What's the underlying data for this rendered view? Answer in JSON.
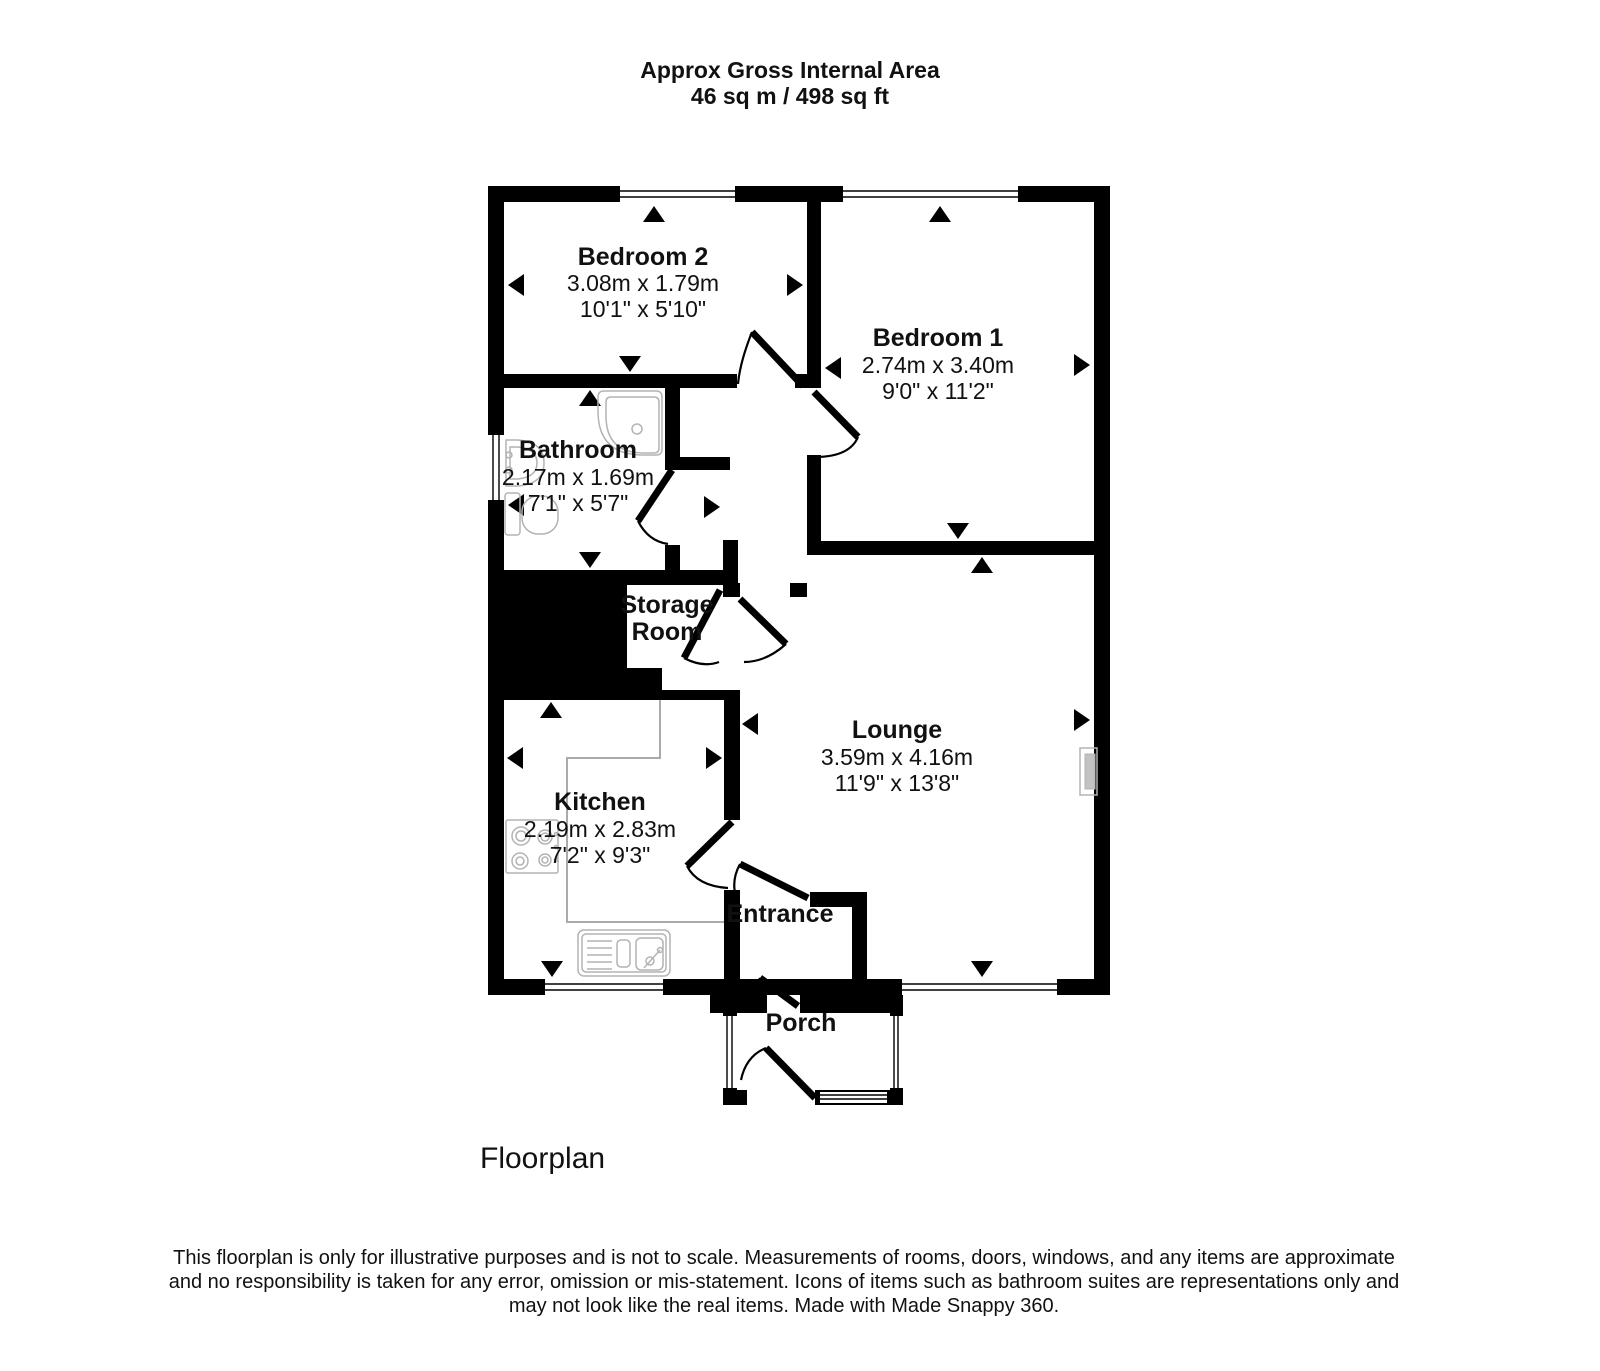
{
  "title": {
    "line1": "Approx Gross Internal Area",
    "line2": "46 sq m / 498 sq ft"
  },
  "rooms": {
    "bedroom2": {
      "name": "Bedroom 2",
      "metric": "3.08m x 1.79m",
      "imperial": "10'1\" x 5'10\""
    },
    "bedroom1": {
      "name": "Bedroom 1",
      "metric": "2.74m x 3.40m",
      "imperial": "9'0\" x 11'2\""
    },
    "bathroom": {
      "name": "Bathroom",
      "metric": "2.17m x 1.69m",
      "imperial": "7'1\" x 5'7\""
    },
    "storage": {
      "name_line1": "Storage",
      "name_line2": "Room"
    },
    "lounge": {
      "name": "Lounge",
      "metric": "3.59m x 4.16m",
      "imperial": "11'9\" x 13'8\""
    },
    "kitchen": {
      "name": "Kitchen",
      "metric": "2.19m x 2.83m",
      "imperial": "7'2\" x 9'3\""
    },
    "entrance": {
      "name": "Entrance"
    },
    "porch": {
      "name": "Porch"
    }
  },
  "footer": {
    "caption": "Floorplan",
    "disclaimer_line1": "This floorplan is only for illustrative purposes and is not to scale. Measurements of rooms, doors, windows, and any items are approximate",
    "disclaimer_line2": "and no responsibility is taken for any error, omission or mis-statement. Icons of items such as bathroom suites are representations only and",
    "disclaimer_line3": "may not look like the real items. Made with Made Snappy 360."
  },
  "colors": {
    "wall": "#000000",
    "background": "#ffffff",
    "fixture_outline": "#b3b3b3"
  }
}
